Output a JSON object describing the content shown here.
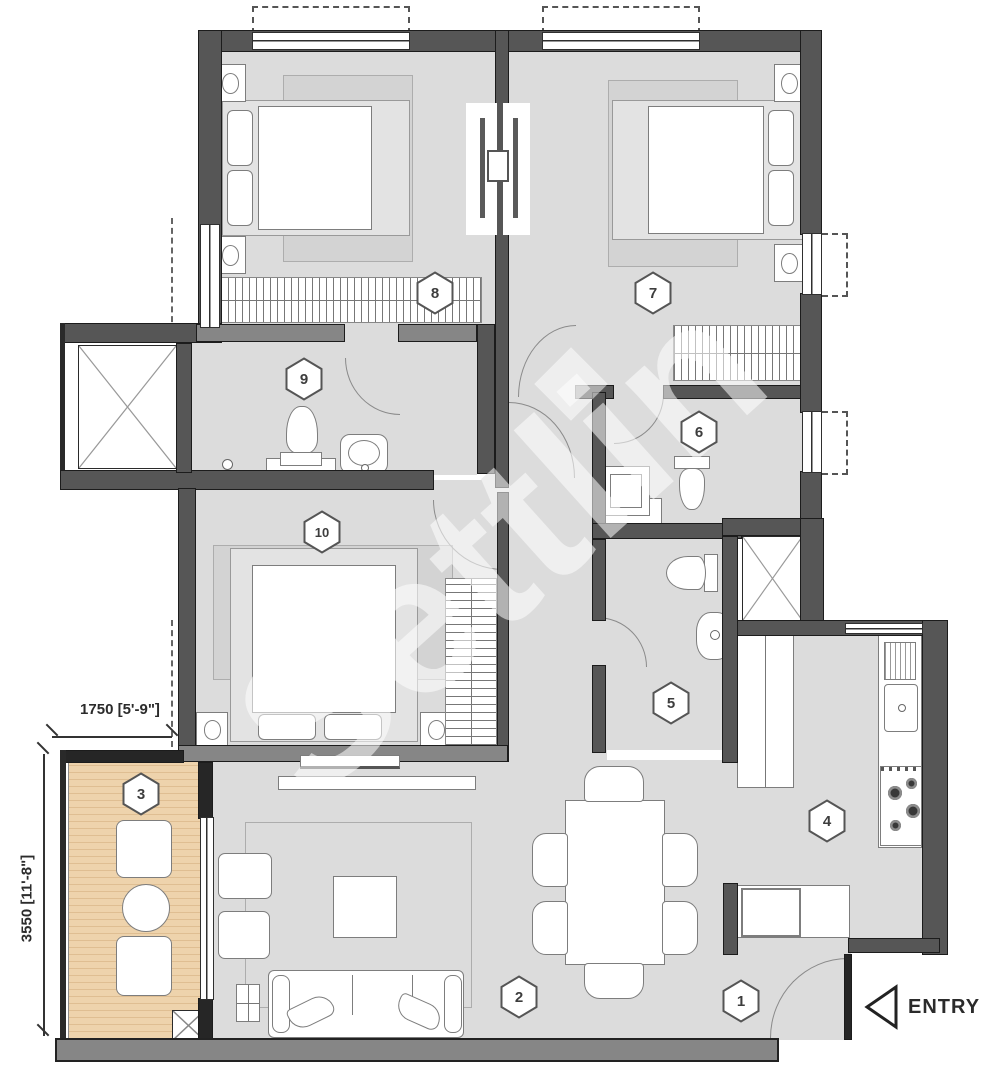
{
  "plan": {
    "watermark": "Settlin",
    "entry_label": "ENTRY",
    "dimensions": {
      "width_label": "1750 [5'-9\"]",
      "height_label": "3550 [11'-8\"]"
    },
    "rooms": [
      {
        "number": "1"
      },
      {
        "number": "2"
      },
      {
        "number": "3"
      },
      {
        "number": "4"
      },
      {
        "number": "5"
      },
      {
        "number": "6"
      },
      {
        "number": "7"
      },
      {
        "number": "8"
      },
      {
        "number": "9"
      },
      {
        "number": "10"
      }
    ],
    "colors": {
      "floor": "#dcdcdc",
      "wall_dark": "#565656",
      "wall_mid": "#868686",
      "deck_wood": "#eed3ac",
      "watermark": "#dadada"
    }
  }
}
